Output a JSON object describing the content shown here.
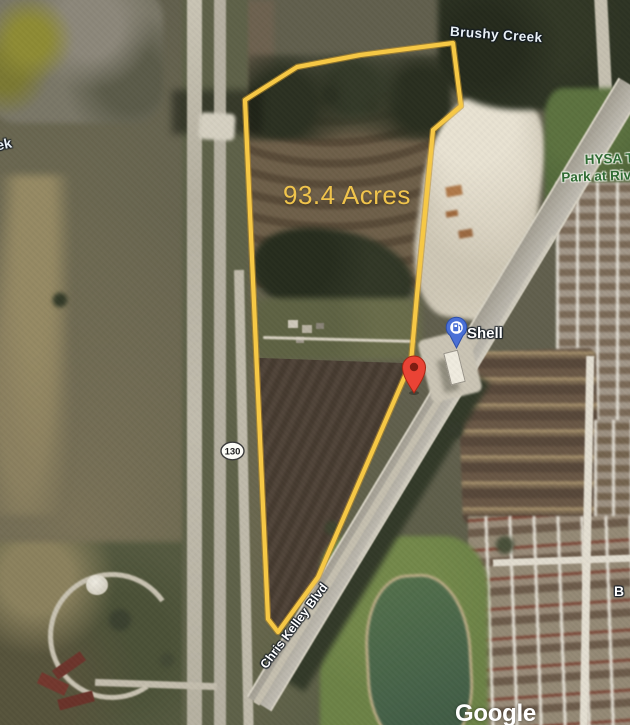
{
  "map_labels": {
    "water_feature": "Brushy Creek",
    "water_feature_partial": "ek",
    "parcel_acreage": "93.4 Acres",
    "gas_station": "Shell",
    "park_line1": "HYSA T",
    "park_line2": "Park at Riv",
    "road": "Chris Kelley Blvd",
    "highway_shield": "130",
    "street_partial": "B",
    "watermark": "Google"
  },
  "colors": {
    "parcel_boundary": "#F6C845",
    "parcel_boundary_edge": "#C1912A",
    "acreage_text": "#F0C44C",
    "red_marker": "#EA4335",
    "red_marker_inner": "#7F1D12",
    "poi_marker_blue": "#4A70D6",
    "park_label_green": "#2F6B33",
    "shield_fill": "#FCFCF7"
  }
}
